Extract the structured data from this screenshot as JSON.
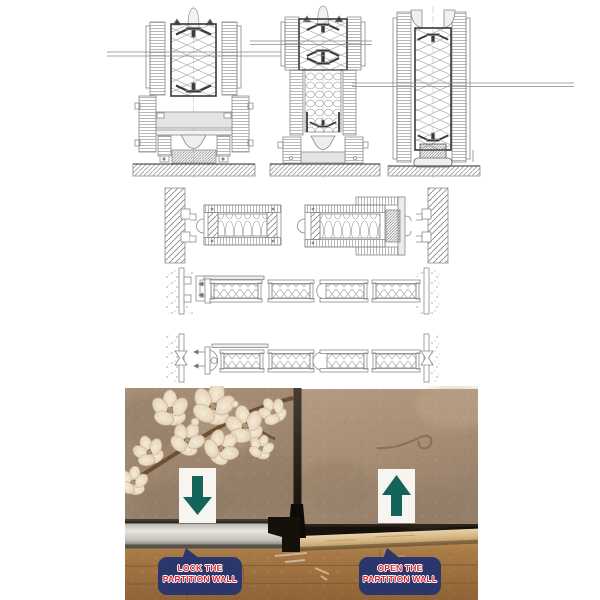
{
  "palette": {
    "arrow_teal": "#156459",
    "label_navy": "#2b366d",
    "label_red": "#d7232e",
    "cad_line": "#8a8a8a",
    "cad_dark": "#3a3a3a",
    "wallpaper_left": "#a08870",
    "wallpaper_right": "#ab9279",
    "blossom": "#ecdfc8",
    "floor": "#a1713f",
    "aluminum": "#d6d4cf",
    "beam": "#d9bd92"
  },
  "cad": {
    "rows": [
      {
        "name": "vertical-sections",
        "items": [
          "head-track-section",
          "mid-joint-section",
          "panel-edge-section"
        ]
      },
      {
        "name": "plan-wall-junctions",
        "items": [
          "left-wall-jamb",
          "panel-plan-closed",
          "panel-plan-telescopic",
          "right-wall-jamb"
        ]
      },
      {
        "name": "plan-panel-chain-closed"
      },
      {
        "name": "plan-panel-chain-expanded"
      }
    ]
  },
  "photo": {
    "arrows": {
      "left": {
        "icon": "down-arrow"
      },
      "right": {
        "icon": "up-arrow"
      }
    },
    "labels": {
      "lock": {
        "line1": "LOCK THE",
        "line2": "PARTITION WALL"
      },
      "open": {
        "line1": "OPEN THE",
        "line2": "PARTITION WALL"
      }
    }
  }
}
